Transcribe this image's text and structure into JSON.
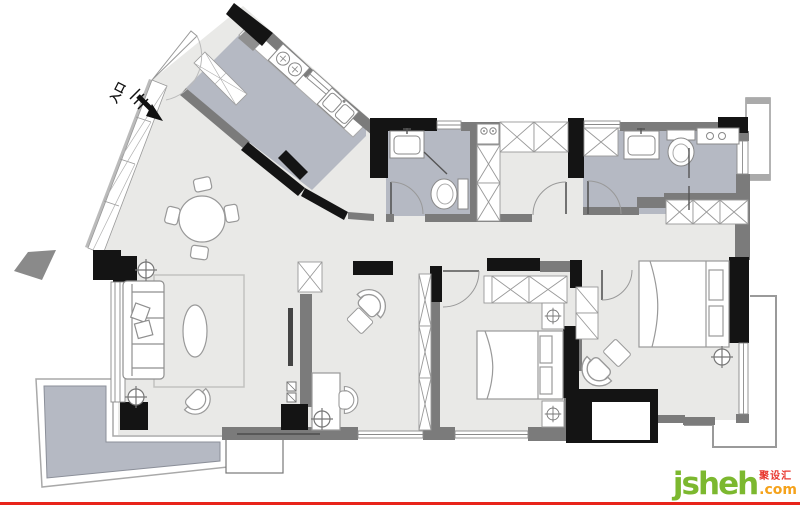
{
  "canvas": {
    "width": 800,
    "height": 505,
    "background": "#ffffff"
  },
  "palette": {
    "wall_black": "#141414",
    "wall_gray": "#7b7b7b",
    "floor_main": "#e9e9e7",
    "floor_wet": "#b5b9c3",
    "furniture_stroke": "#999999",
    "frame_stroke": "#a9a9a9"
  },
  "plan": {
    "type": "apartment-floor-plan",
    "entry": {
      "label": "入口"
    },
    "rooms": [
      {
        "name": "entry-hall",
        "fixtures": [
          "entry-door",
          "shoe-cabinets"
        ]
      },
      {
        "name": "kitchen",
        "fixtures": [
          "counter",
          "gas-stove",
          "double-sink",
          "tall-cabinet"
        ]
      },
      {
        "name": "dining-area",
        "fixtures": [
          "round-table",
          "four-chairs"
        ]
      },
      {
        "name": "living-room",
        "fixtures": [
          "sofa",
          "rug",
          "oval-coffee-table",
          "armchair",
          "floor-lamp",
          "tv-wall",
          "balcony-window"
        ]
      },
      {
        "name": "study-area",
        "fixtures": [
          "desk",
          "desk-chair",
          "bookshelf",
          "armchair",
          "ottoman"
        ]
      },
      {
        "name": "bathroom",
        "fixtures": [
          "washbasin",
          "toilet",
          "glass-screen",
          "door"
        ]
      },
      {
        "name": "laundry-closet",
        "fixtures": [
          "washing-machine",
          "wardrobe-row",
          "cabinet-column",
          "door"
        ]
      },
      {
        "name": "master-bathroom",
        "fixtures": [
          "wardrobe-cell",
          "washbasin",
          "toilet",
          "shower-counter",
          "glass-screen",
          "door"
        ]
      },
      {
        "name": "bedroom",
        "fixtures": [
          "double-bed",
          "headboard-pillows",
          "two-nightstands",
          "bedside-lamps",
          "wardrobe-row",
          "door"
        ]
      },
      {
        "name": "master-bedroom",
        "fixtures": [
          "double-bed",
          "headboard-pillows",
          "wardrobe-row",
          "armchair",
          "ottoman",
          "ceiling-lamp",
          "bay-platform"
        ]
      },
      {
        "name": "balcony",
        "fixtures": [
          "tile-floor"
        ]
      },
      {
        "name": "side-terrace",
        "fixtures": []
      }
    ]
  },
  "watermark": {
    "brand": "jsheh",
    "tld": ".com",
    "chinese": "聚设汇",
    "brand_color": "#7cb82f",
    "tld_color": "#f5a21b",
    "chinese_color": "#e8382f"
  },
  "footer_rule": {
    "color": "#e8231a"
  }
}
